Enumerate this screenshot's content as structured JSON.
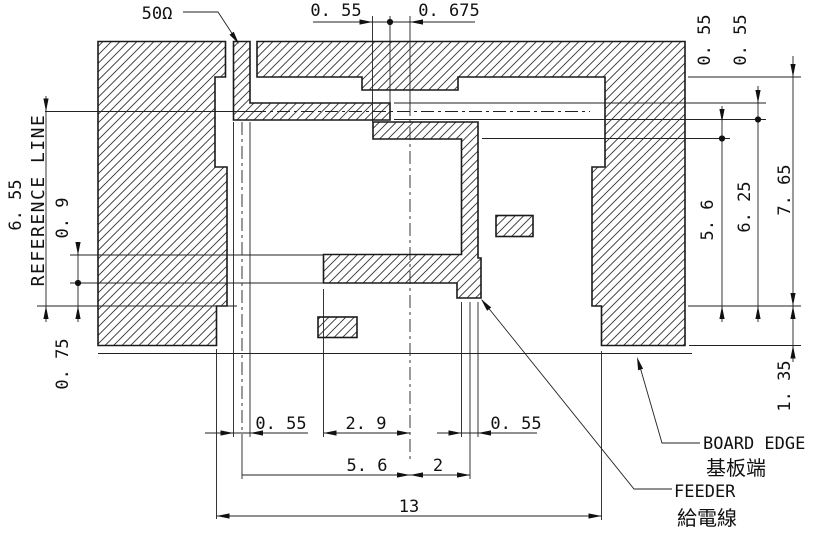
{
  "labels": {
    "impedance": "50Ω",
    "reference_line": "REFERENCE LINE",
    "board_edge_en": "BOARD EDGE",
    "board_edge_ja": "基板端",
    "feeder_en": "FEEDER",
    "feeder_ja": "給電線"
  },
  "dims": {
    "top_offset": "0. 55",
    "top_to_center": "0. 675",
    "right_upper_strip": "0. 55",
    "right_lower_strip": "0. 55",
    "right_5_6": "5. 6",
    "right_6_25": "6. 25",
    "right_7_65": "7. 65",
    "right_foot": "1. 35",
    "left_6_55": "6. 55",
    "left_strip_0_9": "0. 9",
    "left_step_0_75": "0. 75",
    "bottom_feed_width": "0. 55",
    "bottom_2_9": "2. 9",
    "bottom_bar_width": "0. 55",
    "bottom_5_6": "5. 6",
    "bottom_2": "2",
    "bottom_13": "13"
  }
}
